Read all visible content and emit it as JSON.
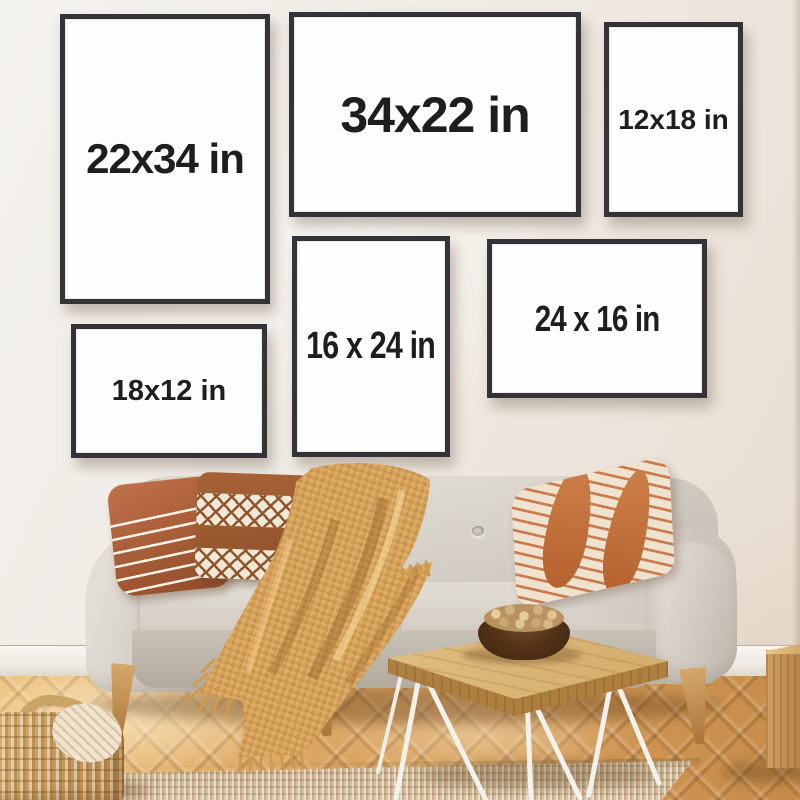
{
  "frames": [
    {
      "label": "22x34 in"
    },
    {
      "label": "34x22 in"
    },
    {
      "label": "12x18 in"
    },
    {
      "label": "16 x 24 in"
    },
    {
      "label": "24 x 16 in"
    },
    {
      "label": "18x12 in"
    }
  ],
  "palette": {
    "wall": "#efeae3",
    "frame_border": "#333338",
    "frame_paper": "#fdfdfd",
    "label_text": "#1e1e20",
    "floor_wood": "#d49a5c",
    "rug_jute": "#dcc6a4",
    "sofa_fabric": "#d6d1c8",
    "blanket_mustard": "#d7a258",
    "pillow_terracotta": "#b06a42",
    "table_wood": "#dcba7c",
    "bowl_walnut": "#573619"
  },
  "scene_objects": [
    "gallery wall of six size-guide frames",
    "light gray scandinavian sofa",
    "striped terracotta pillow",
    "diamond pattern pillow",
    "diagonal stripe pillow",
    "mustard waffle knit throw blanket",
    "live edge coffee table with hairpin legs",
    "wooden bowl of walnuts",
    "woven basket",
    "jute rug",
    "wood cube side table",
    "herringbone parquet floor"
  ]
}
